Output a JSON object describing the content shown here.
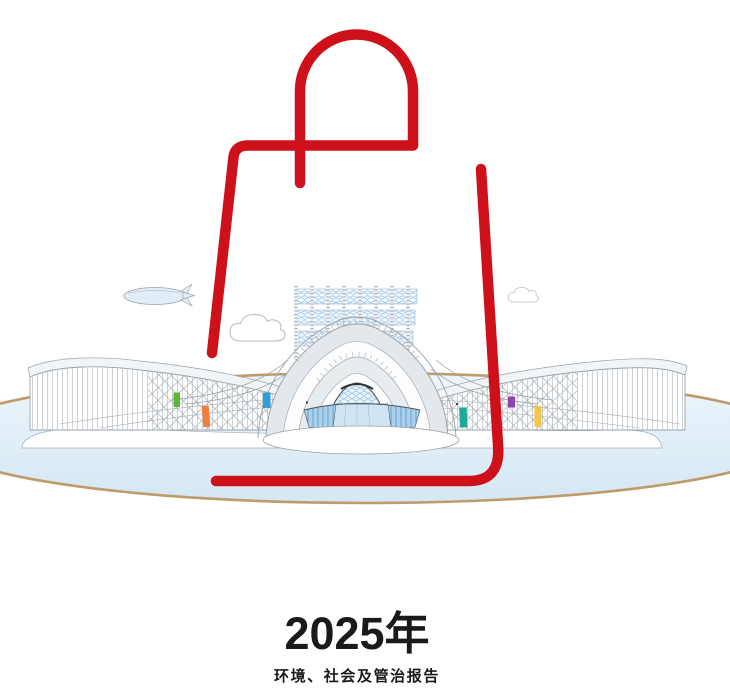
{
  "cover": {
    "year_title": "2025年",
    "subtitle": "环境、社会及管治报告"
  },
  "illustration": {
    "description_labels": {
      "bag": "red-shopping-bag-outline",
      "building": "exhibition-center-building",
      "airship": "airship",
      "clouds": "clouds",
      "ground": "oval-water-plaza"
    },
    "visitor_markers": [
      "green",
      "orange",
      "blue",
      "teal",
      "purple",
      "yellow"
    ]
  },
  "palette": {
    "accent_red": "#cd1019",
    "ellipse_tan": "#bf9a6a",
    "water_blue": "#d4e7f4",
    "outline_gray": "#9aa2aa",
    "building_gray": "#e2e8ec",
    "lattice_blue": "#a9cde9",
    "glass_blue": "#a8d1ee",
    "text_black": "#1a1a1a",
    "accent_green": "#5cb832",
    "accent_orange": "#f07f3c",
    "accent_blue": "#2e9fd4",
    "accent_teal": "#1bab96",
    "accent_purple": "#8e44ad",
    "accent_yellow": "#f2c84b"
  }
}
